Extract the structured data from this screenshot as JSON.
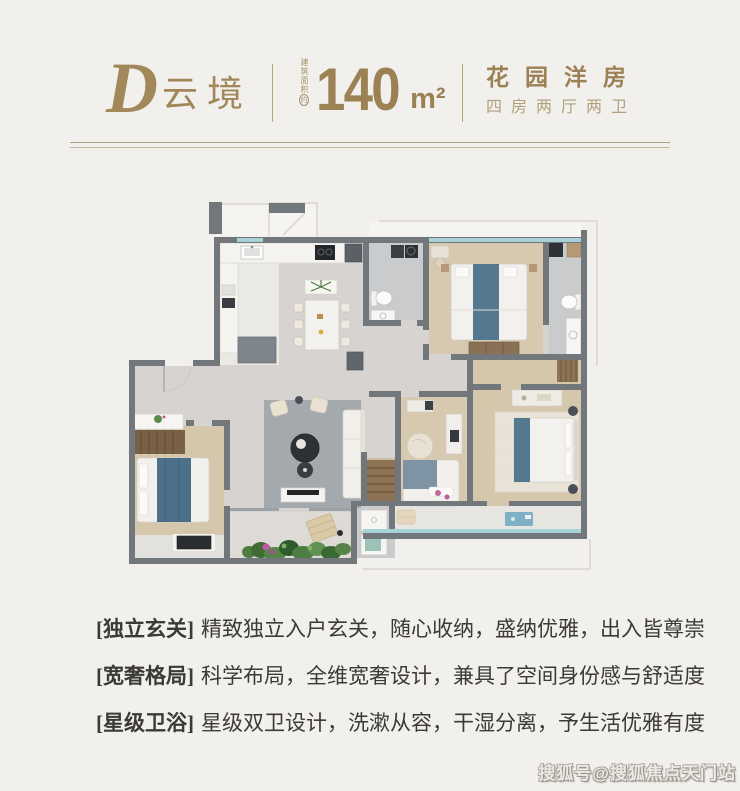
{
  "page": {
    "background": "#f2f0ec"
  },
  "header": {
    "unit_letter": "D",
    "unit_name": "云境",
    "area_label_vertical": "建筑面积",
    "area_label_circled": "约",
    "area_value": "140",
    "area_unit": "m²",
    "product_type": "花园洋房",
    "layout_spec": "四房两厅两卫",
    "accent_color": "#9c8155"
  },
  "features": [
    {
      "tag": "[独立玄关]",
      "desc": "精致独立入户玄关，随心收纳，盛纳优雅，出入皆尊崇"
    },
    {
      "tag": "[宽奢格局]",
      "desc": "科学布局，全维宽奢设计，兼具了空间身份感与舒适度"
    },
    {
      "tag": "[星级卫浴]",
      "desc": "星级双卫设计，洗漱从容，干湿分离，予生活优雅有度"
    }
  ],
  "watermark": {
    "text": "搜狐号@搜狐焦点天门站"
  },
  "floor_plan": {
    "regions": [
      "entry-hall",
      "kitchen",
      "dining-area",
      "living-room",
      "bedroom-top",
      "bathroom-ensuite-left",
      "bathroom-ensuite-right",
      "bedroom-left",
      "bedroom-small",
      "master-bedroom",
      "bathroom-second",
      "master-balcony",
      "garden-patio",
      "dressing-corridor",
      "closet-niche"
    ],
    "colors": {
      "wall": "#72777c",
      "tile_floor": "#d6d3d0",
      "wood_floor": "#d7c9af",
      "bath_floor": "#c9cbcd",
      "glass": "#a7d2d5",
      "bed_accent_blue": "#54788f",
      "rug_gray": "#a4a9ae",
      "plant_green": "#4c7d41",
      "flower_pink": "#c058a8"
    }
  }
}
